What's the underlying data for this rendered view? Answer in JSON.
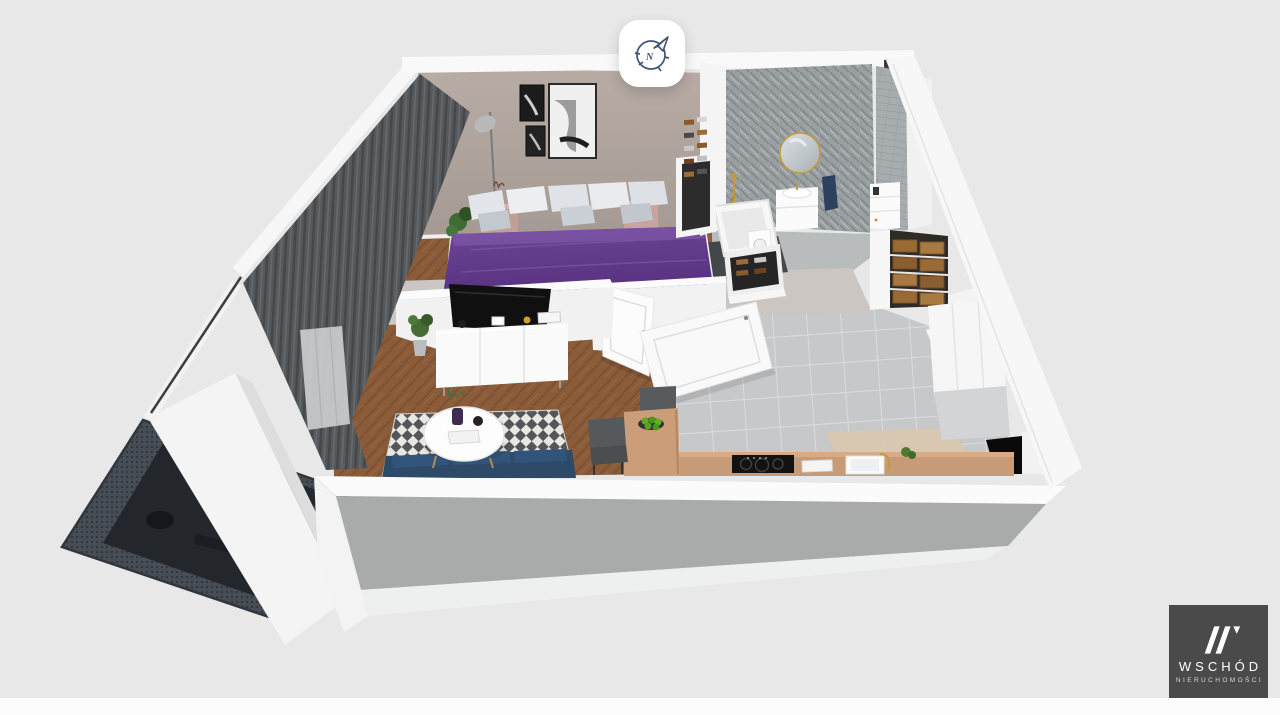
{
  "viewport": {
    "width": 1280,
    "height": 715,
    "background": "#e8e8e8",
    "footer_strip_color": "#fcfcfc"
  },
  "compass": {
    "label": "N",
    "icon": "compass-north-icon",
    "stroke_color": "#3f5576",
    "background": "#ffffff"
  },
  "watermark": {
    "brand": "WSCHÓD",
    "tagline": "NIERUCHOMOŚCI",
    "background": "#4a4a4a",
    "text_color": "#ffffff",
    "mark": "w-slashes-icon"
  },
  "scene": {
    "type": "3d-floorplan-render",
    "rooms": [
      "bedroom",
      "living-room",
      "bathroom",
      "hallway",
      "kitchen-dining",
      "balcony"
    ],
    "palette": {
      "outer_walls": "#f7f7f7",
      "bedroom_wall": "#b0a49d",
      "wood_floor": "#8a5c3a",
      "tile_floor": "#c6c8c9",
      "bath_wall_tile": "#9aa0a2",
      "bed_duvet": "#6d4796",
      "sofa": "#2d4a68",
      "rug_base": "#e9e7e1",
      "rug_diamond": "#53575a",
      "balcony_mesh": "#474d54",
      "counter_wood": "#c89b78",
      "accent_gold": "#c29b38",
      "nightstand": "#c29e97",
      "apples": "#5fae1f"
    }
  }
}
